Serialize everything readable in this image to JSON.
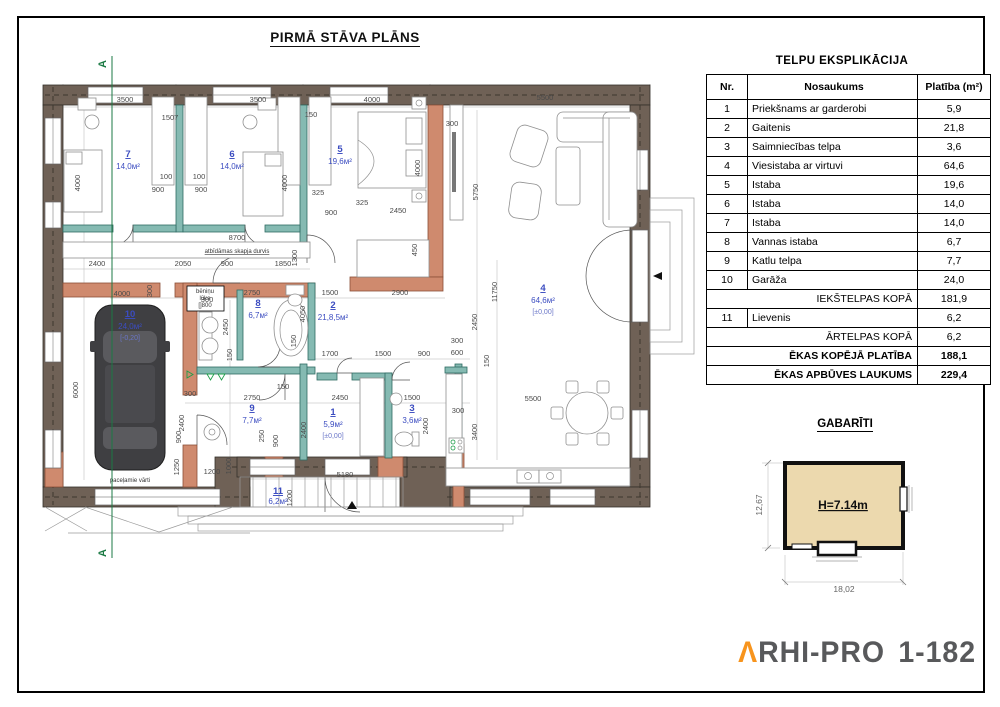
{
  "title": "PIRMĀ STĀVA PLĀNS",
  "table": {
    "title": "TELPU EKSPLIKĀCIJA",
    "headers": [
      "Nr.",
      "Nosaukums",
      "Platība (m²)"
    ],
    "rows": [
      [
        "1",
        "Priekšnams ar garderobi",
        "5,9"
      ],
      [
        "2",
        "Gaitenis",
        "21,8"
      ],
      [
        "3",
        "Saimniecības telpa",
        "3,6"
      ],
      [
        "4",
        "Viesistaba ar virtuvi",
        "64,6"
      ],
      [
        "5",
        "Istaba",
        "19,6"
      ],
      [
        "6",
        "Istaba",
        "14,0"
      ],
      [
        "7",
        "Istaba",
        "14,0"
      ],
      [
        "8",
        "Vannas istaba",
        "6,7"
      ],
      [
        "9",
        "Katlu telpa",
        "7,7"
      ],
      [
        "10",
        "Garāža",
        "24,0"
      ]
    ],
    "sum1": {
      "label": "IEKŠTELPAS KOPĀ",
      "value": "181,9"
    },
    "row11": [
      "11",
      "Lievenis",
      "6,2"
    ],
    "sum2": {
      "label": "ĀRTELPAS KOPĀ",
      "value": "6,2"
    },
    "total1": {
      "label": "ĒKAS KOPĒJĀ PLATĪBA",
      "value": "188,1"
    },
    "total2": {
      "label": "ĒKAS APBŪVES LAUKUMS",
      "value": "229,4"
    }
  },
  "gabariti": {
    "title": "GABARĪTI",
    "height": "H=7.14m",
    "width": "18,02",
    "depth": "12,67"
  },
  "logo": {
    "lambda": "Λ",
    "name": "RHI-PRO",
    "code": "1-182"
  },
  "plan": {
    "section_label": "A",
    "rooms": [
      {
        "nr": "7",
        "area": "14,0м²"
      },
      {
        "nr": "6",
        "area": "14,0м²"
      },
      {
        "nr": "5",
        "area": "19,6м²"
      },
      {
        "nr": "4",
        "area": "64,6м²",
        "elev": "[±0,00]"
      },
      {
        "nr": "10",
        "area": "24,0м²",
        "elev": "[-0,20]"
      },
      {
        "nr": "8",
        "area": "6,7м²"
      },
      {
        "nr": "2",
        "area": "21,8,5м²"
      },
      {
        "nr": "9",
        "area": "7,7м²"
      },
      {
        "nr": "1",
        "area": "5,9м²",
        "elev": "[±0,00]"
      },
      {
        "nr": "3",
        "area": "3,6м²"
      },
      {
        "nr": "11",
        "area": "6,2м²"
      }
    ],
    "notes": {
      "closet": "atbīdāmas skapja durvis",
      "attic1": "bēniņu",
      "attic2": "lūka",
      "attic3": "[]800",
      "gate": "paceļamie vārti"
    },
    "dims": [
      "3500",
      "1507",
      "3500",
      "150",
      "4000",
      "300",
      "5500",
      "4000",
      "4000",
      "4000",
      "5750",
      "100",
      "100",
      "900",
      "900",
      "325",
      "900",
      "325",
      "2450",
      "8700",
      "2400",
      "2050",
      "900",
      "1850",
      "1300",
      "1500",
      "2900",
      "4000",
      "300",
      "2750",
      "4050",
      "1700",
      "1500",
      "900",
      "300",
      "600",
      "150",
      "6000",
      "2450",
      "150",
      "11750",
      "2450",
      "2750",
      "2450",
      "1500",
      "300",
      "3400",
      "2400",
      "2400",
      "250",
      "900",
      "2400",
      "900",
      "1250",
      "1200",
      "1000",
      "5180",
      "1200",
      "150",
      "300",
      "5500",
      "300",
      "150",
      "450"
    ]
  }
}
